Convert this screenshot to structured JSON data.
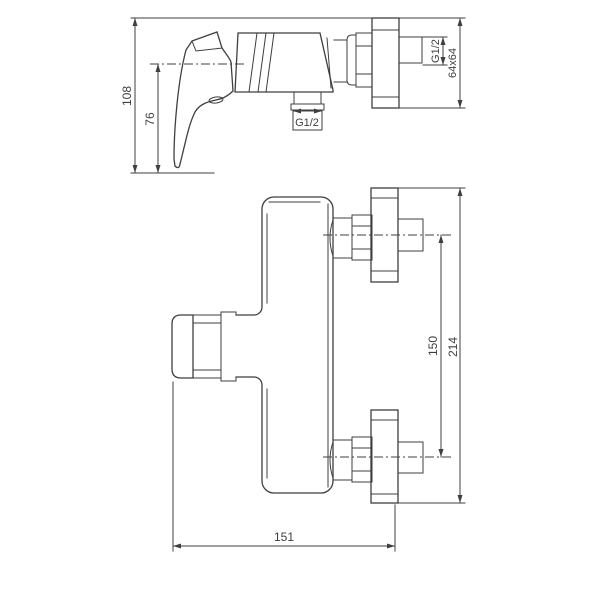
{
  "colors": {
    "line": "#3f3f3f",
    "background": "#ffffff"
  },
  "views": {
    "side": {
      "dims": {
        "overall_height": "108",
        "handle_height": "76",
        "outlet_thread": "G1/2",
        "inlet_thread": "G1/2",
        "wall_flange": "64x64"
      }
    },
    "front": {
      "dims": {
        "connection_spacing": "150",
        "overall_height": "214",
        "overall_width": "151"
      }
    }
  }
}
